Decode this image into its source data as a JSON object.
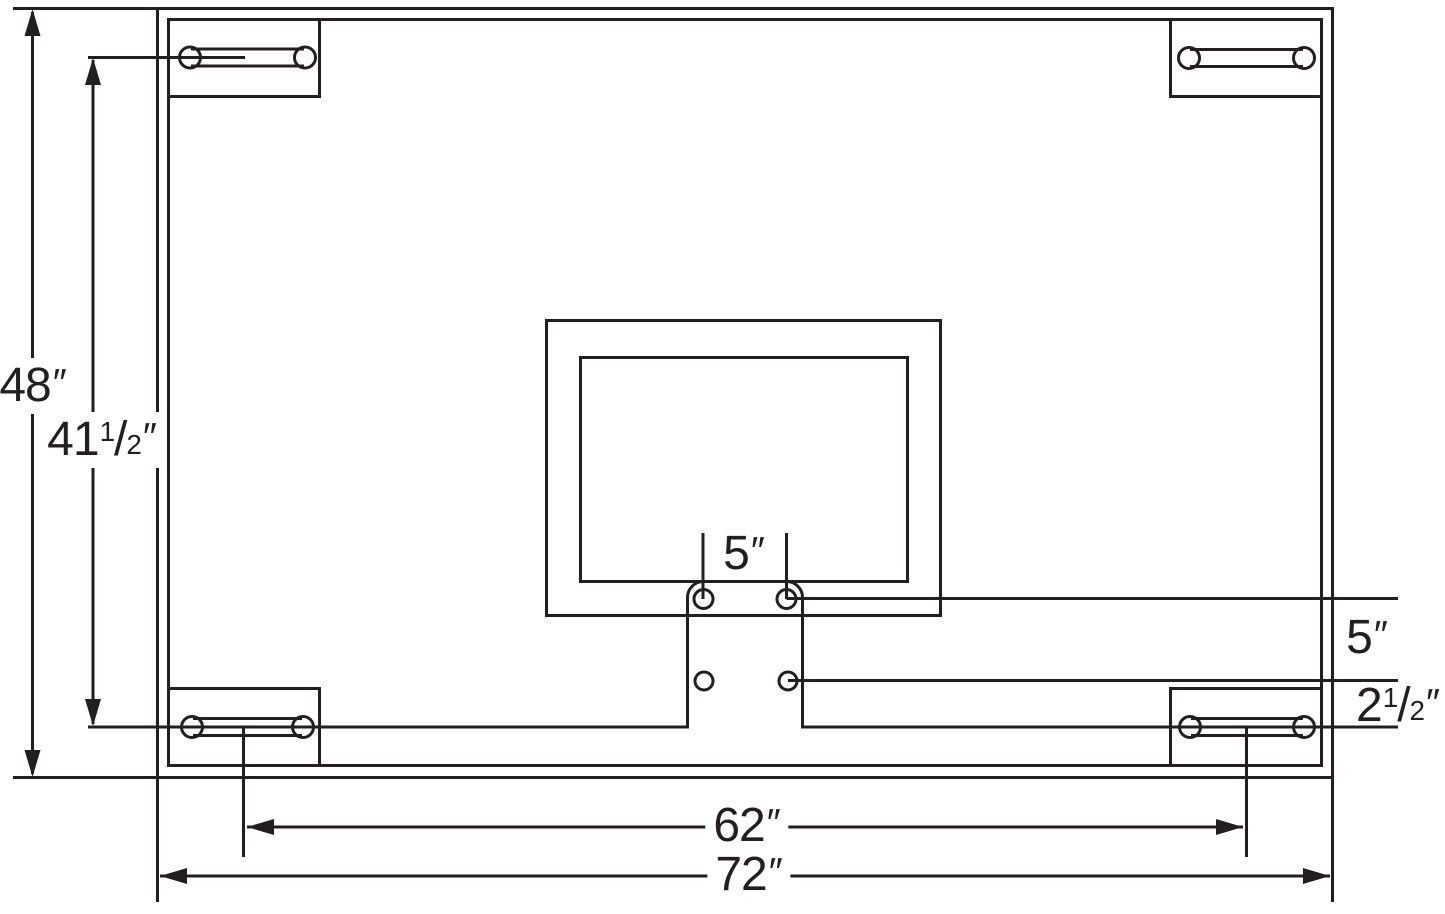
{
  "diagram": {
    "line_color": "#231f20",
    "background": "#ffffff",
    "dims": {
      "board_height": {
        "text": "48",
        "prime": "″",
        "value_in": 48
      },
      "slot_height": {
        "whole": "41",
        "num": "1",
        "sep": "/",
        "den": "2",
        "prime": "″",
        "value_in": 41.5
      },
      "hole_gap_h": {
        "text": "5",
        "prime": "″",
        "value_in": 5
      },
      "hole_gap_v": {
        "text": "5",
        "prime": "″",
        "value_in": 5
      },
      "hole_to_slot": {
        "whole": "2",
        "num": "1",
        "sep": "/",
        "den": "2",
        "prime": "″",
        "value_in": 2.5
      },
      "slot_span": {
        "text": "62",
        "prime": "″",
        "value_in": 62
      },
      "board_width": {
        "text": "72",
        "prime": "″",
        "value_in": 72
      }
    }
  }
}
